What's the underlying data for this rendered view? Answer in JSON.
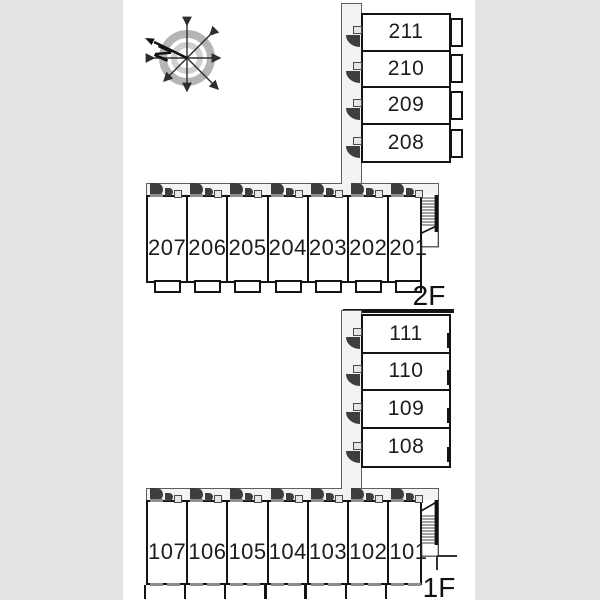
{
  "compass": {
    "label": "N"
  },
  "floors": [
    {
      "label": "2F",
      "stack_rooms": [
        "211",
        "210",
        "209",
        "208"
      ],
      "row_rooms": [
        "207",
        "206",
        "205",
        "204",
        "203",
        "202",
        "201"
      ]
    },
    {
      "label": "1F",
      "stack_rooms": [
        "111",
        "110",
        "109",
        "108"
      ],
      "row_rooms": [
        "107",
        "106",
        "105",
        "104",
        "103",
        "102",
        "101"
      ]
    }
  ],
  "colors": {
    "background": "#e4e4e4",
    "paper": "#ffffff",
    "wall": "#141414",
    "corridor_fill": "#f3f3f3",
    "door_swing": "#3e3e3e",
    "gray_detail": "#8c8c8c"
  }
}
